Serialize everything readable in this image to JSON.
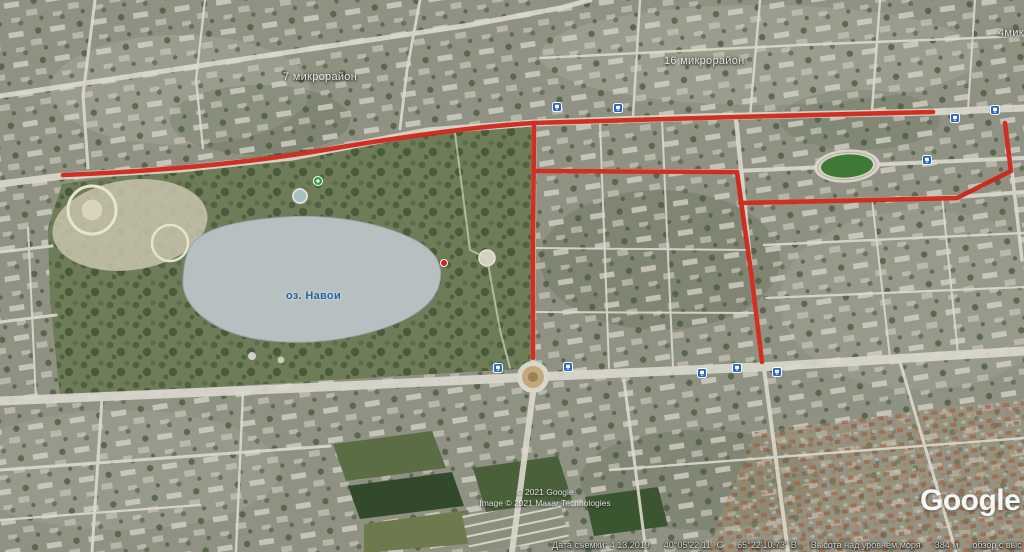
{
  "colors": {
    "route_red": "#d02318",
    "transit_blue": "#2c66c4",
    "lake_label_blue": "#27639f"
  },
  "map_labels": {
    "district_7": "7 микрорайон",
    "district_16": "16 микрорайон",
    "district_4_clipped": "4мик",
    "lake": "оз. Навои"
  },
  "attribution": {
    "copyright_line1": "© 2021 Google",
    "copyright_line2": "Image © 2021 Maxar Technologies",
    "logo": "Google"
  },
  "status_bar": {
    "capture_date": "Дата съемки: 4.13.2019",
    "latitude": "40°05'22.11\" С",
    "longitude": "65°22'10.73\" В",
    "elevation_label": "Высота над уровнем моря",
    "elevation_value": "384 м",
    "eye_altitude_clipped": "обзор с выс"
  }
}
